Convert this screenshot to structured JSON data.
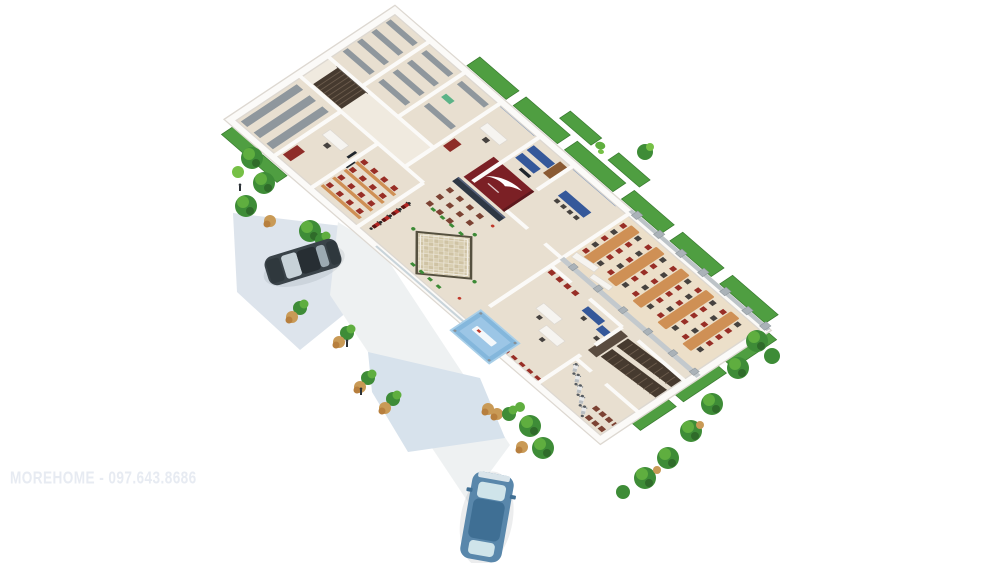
{
  "watermark": {
    "text": "MOREHOME - 097.643.8686"
  },
  "scene": {
    "display_motorcycles": 4,
    "canteen_table_rows": 5,
    "parked_cars": 2,
    "people_figures": 3
  },
  "colors": {
    "bg": "#ffffff",
    "floor": "#e8dfd0",
    "floor-light": "#f0eadf",
    "floor-warm": "#ecdfc9",
    "wall": "#fbfaf8",
    "wall-shade": "#ddd8d1",
    "red-wall": "#7b2025",
    "counter": "#2e3744",
    "wood": "#cf9055",
    "chair-red": "#982e26",
    "chair-brown": "#7c4233",
    "shelf-gray": "#8f979d",
    "stair-dark": "#463a2f",
    "grass": "#4f9e41",
    "hedge": "#3c8a36",
    "pavement": "#dde4ec",
    "walkway": "#eef1f2",
    "plaza": "#d7e2ec",
    "canopy-blue": "#84b7dc",
    "car-dark": "#3a4349",
    "car-blue": "#5987ab",
    "glass-blue": "#cfe4ea",
    "tile-tan": "#cfc3a4",
    "tile-border": "#55503f",
    "column-gray": "#aab2b8",
    "watermark": "#e7ebf2"
  }
}
